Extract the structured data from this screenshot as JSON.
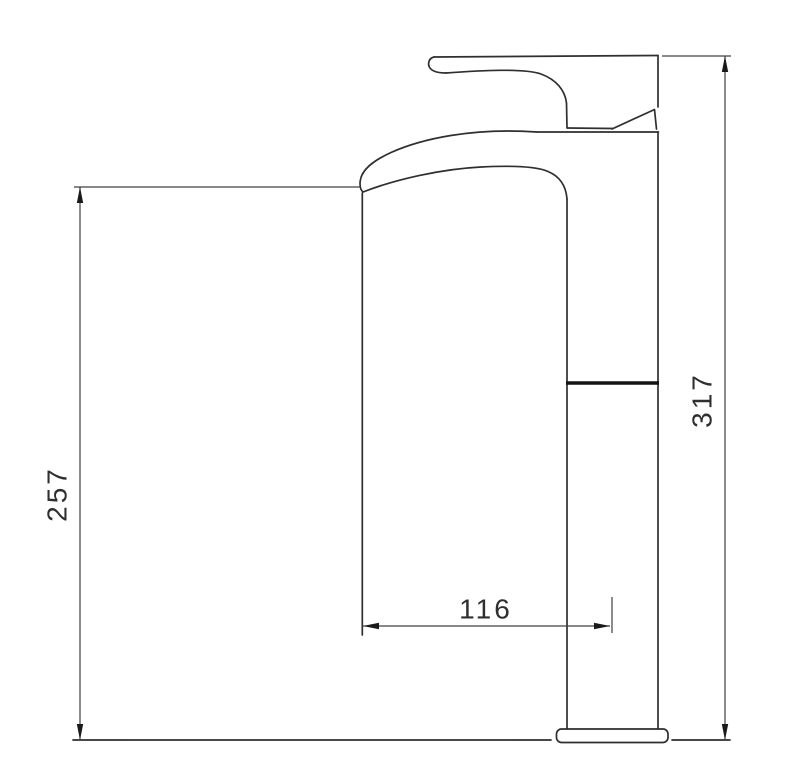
{
  "drawing": {
    "type": "technical-dimension-drawing",
    "subject": "tall single-lever basin mixer tap, side elevation",
    "background_color": "#ffffff",
    "line_color": "#2f2f2f",
    "dimension_line_color": "#404040",
    "dimensions": {
      "spout_height": "257",
      "total_height": "317",
      "spout_reach": "116"
    },
    "units_note": "",
    "parts": [
      "lever-handle",
      "handle-wedge",
      "spout",
      "body",
      "riser-column",
      "base-plate",
      "mounting-surface-line"
    ]
  }
}
